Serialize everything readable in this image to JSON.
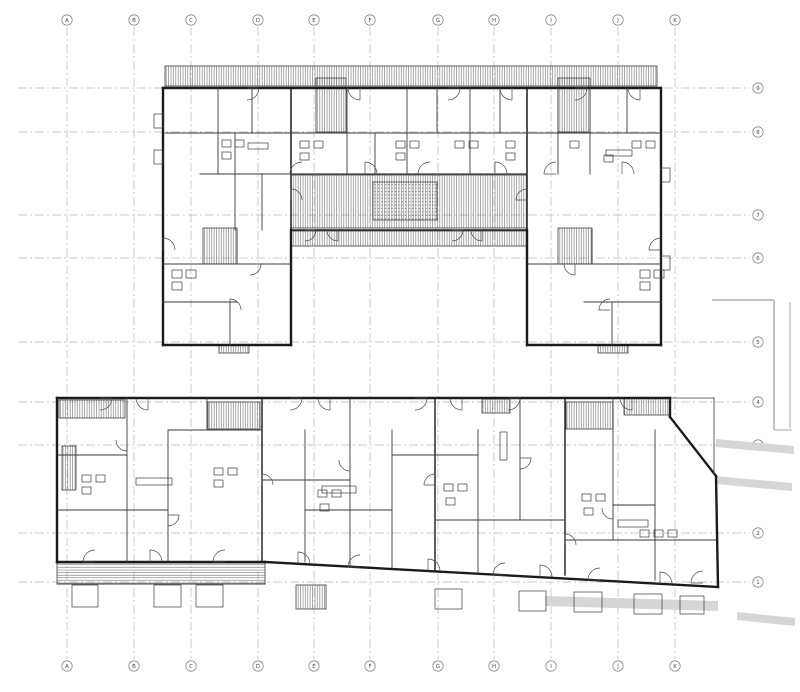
{
  "sheet": {
    "width": 800,
    "height": 692,
    "background": "#ffffff",
    "kind": "architectural floor plan, two buildings"
  },
  "colors": {
    "wall": "#1b1b1b",
    "thin_wall": "#3a3a3a",
    "hatch_line": "#707070",
    "grid_line": "#b8b8b8",
    "bubble_stroke": "#8a8a8a",
    "label_text": "#444444",
    "context_fill": "#d6d6d6",
    "context_stroke": "#c4c4c4"
  },
  "grid": {
    "bubble_r": 5.2,
    "col_bubble_top_y": 20,
    "col_bubble_bottom_y": 666,
    "col_line_y1": 27,
    "col_line_y2": 659,
    "row_bubble_x": 758,
    "row_line_x1": 18,
    "row_line_x2": 750,
    "columns": [
      {
        "label": "A",
        "x": 67
      },
      {
        "label": "B",
        "x": 134
      },
      {
        "label": "C",
        "x": 191
      },
      {
        "label": "D",
        "x": 258
      },
      {
        "label": "E",
        "x": 314
      },
      {
        "label": "F",
        "x": 370
      },
      {
        "label": "G",
        "x": 438
      },
      {
        "label": "H",
        "x": 494
      },
      {
        "label": "I",
        "x": 551
      },
      {
        "label": "J",
        "x": 618
      },
      {
        "label": "K",
        "x": 675
      }
    ],
    "rows": [
      {
        "label": "9",
        "y": 88
      },
      {
        "label": "8",
        "y": 132
      },
      {
        "label": "7",
        "y": 215
      },
      {
        "label": "6",
        "y": 258
      },
      {
        "label": "5",
        "y": 342
      },
      {
        "label": "4",
        "y": 402
      },
      {
        "label": "3",
        "y": 445
      },
      {
        "label": "2",
        "y": 533
      },
      {
        "label": "1",
        "y": 582
      }
    ]
  },
  "drawing": {
    "walls": [
      [
        163,
        88,
        661,
        88,
        2.4
      ],
      [
        163,
        88,
        163,
        345,
        2.4
      ],
      [
        661,
        88,
        661,
        345,
        2.4
      ],
      [
        163,
        345,
        291,
        345,
        2.4
      ],
      [
        527,
        345,
        661,
        345,
        2.4
      ],
      [
        291,
        230,
        291,
        345,
        2.4
      ],
      [
        527,
        230,
        527,
        345,
        2.4
      ],
      [
        291,
        88,
        291,
        230,
        1.5
      ],
      [
        527,
        88,
        527,
        230,
        1.5
      ],
      [
        165,
        133,
        659,
        133,
        0.9
      ],
      [
        291,
        174,
        527,
        174,
        1.2
      ],
      [
        291,
        230,
        527,
        230,
        1.5
      ],
      [
        218,
        88,
        218,
        174,
        0.9
      ],
      [
        252,
        88,
        252,
        133,
        0.9
      ],
      [
        347,
        88,
        347,
        174,
        0.9
      ],
      [
        375,
        133,
        375,
        174,
        0.9
      ],
      [
        407,
        88,
        407,
        174,
        0.9
      ],
      [
        437,
        88,
        437,
        133,
        0.9
      ],
      [
        470,
        88,
        470,
        174,
        0.9
      ],
      [
        500,
        88,
        500,
        133,
        0.9
      ],
      [
        558,
        88,
        558,
        174,
        0.9
      ],
      [
        590,
        88,
        590,
        174,
        0.9
      ],
      [
        627,
        88,
        627,
        133,
        0.9
      ],
      [
        235,
        133,
        235,
        230,
        0.9
      ],
      [
        262,
        174,
        262,
        230,
        0.9
      ],
      [
        200,
        174,
        291,
        174,
        0.9
      ],
      [
        163,
        264,
        291,
        264,
        0.9
      ],
      [
        163,
        302,
        237,
        302,
        0.9
      ],
      [
        237,
        230,
        237,
        264,
        0.9
      ],
      [
        230,
        302,
        230,
        345,
        0.9
      ],
      [
        527,
        264,
        661,
        264,
        0.9
      ],
      [
        584,
        302,
        661,
        302,
        0.9
      ],
      [
        612,
        302,
        612,
        345,
        0.9
      ],
      [
        592,
        230,
        592,
        264,
        0.9
      ],
      [
        57,
        398,
        670,
        398,
        2.4
      ],
      [
        57,
        398,
        57,
        562,
        2.4
      ],
      [
        57,
        562,
        265,
        562,
        2.4
      ],
      [
        265,
        562,
        718,
        587,
        2.4
      ],
      [
        716,
        476,
        718,
        587,
        2.4
      ],
      [
        670,
        417,
        716,
        476,
        2.4
      ],
      [
        670,
        398,
        670,
        417,
        2.4
      ],
      [
        670,
        398,
        714,
        398,
        0.8
      ],
      [
        714,
        398,
        714,
        474,
        0.8
      ],
      [
        127,
        398,
        127,
        562,
        0.9
      ],
      [
        168,
        430,
        168,
        562,
        0.9
      ],
      [
        207,
        398,
        207,
        430,
        0.9
      ],
      [
        262,
        398,
        262,
        562,
        1.4
      ],
      [
        305,
        430,
        305,
        562,
        0.9
      ],
      [
        350,
        398,
        350,
        566,
        0.9
      ],
      [
        392,
        430,
        392,
        568,
        0.9
      ],
      [
        435,
        398,
        435,
        570,
        1.4
      ],
      [
        478,
        430,
        478,
        572,
        0.9
      ],
      [
        520,
        398,
        520,
        520,
        0.9
      ],
      [
        565,
        398,
        565,
        575,
        1.4
      ],
      [
        613,
        398,
        613,
        540,
        0.9
      ],
      [
        655,
        430,
        655,
        580,
        0.9
      ],
      [
        168,
        430,
        262,
        430,
        0.9
      ],
      [
        57,
        455,
        127,
        455,
        0.9
      ],
      [
        57,
        510,
        168,
        510,
        0.9
      ],
      [
        262,
        480,
        350,
        480,
        0.9
      ],
      [
        305,
        510,
        392,
        510,
        0.9
      ],
      [
        392,
        455,
        478,
        455,
        0.9
      ],
      [
        435,
        520,
        565,
        520,
        0.9
      ],
      [
        565,
        540,
        716,
        540,
        0.9
      ],
      [
        613,
        505,
        655,
        505,
        0.9
      ],
      [
        57,
        584,
        265,
        584,
        0.9
      ]
    ],
    "hatch_rects": [
      [
        165,
        66,
        492,
        20,
        "v"
      ],
      [
        316,
        78,
        30,
        54,
        "v"
      ],
      [
        558,
        78,
        32,
        54,
        "v"
      ],
      [
        291,
        175,
        236,
        53,
        "v"
      ],
      [
        373,
        182,
        64,
        38,
        "dots"
      ],
      [
        291,
        231,
        236,
        15,
        "v"
      ],
      [
        203,
        228,
        34,
        36,
        "v"
      ],
      [
        558,
        228,
        34,
        36,
        "v"
      ],
      [
        219,
        345,
        30,
        8,
        "v"
      ],
      [
        598,
        345,
        30,
        8,
        "v"
      ],
      [
        59,
        400,
        66,
        18,
        "v"
      ],
      [
        624,
        398,
        46,
        17,
        "v"
      ],
      [
        482,
        399,
        28,
        14,
        "v"
      ],
      [
        208,
        402,
        52,
        27,
        "v"
      ],
      [
        566,
        402,
        47,
        27,
        "v"
      ],
      [
        57,
        563,
        208,
        21,
        "h"
      ],
      [
        296,
        585,
        30,
        24,
        "v"
      ],
      [
        62,
        446,
        14,
        44,
        "v"
      ]
    ],
    "fixtures": [
      [
        222,
        140,
        9,
        7
      ],
      [
        235,
        140,
        9,
        7
      ],
      [
        222,
        152,
        9,
        7
      ],
      [
        300,
        141,
        9,
        7
      ],
      [
        314,
        141,
        9,
        7
      ],
      [
        300,
        153,
        9,
        7
      ],
      [
        396,
        141,
        9,
        7
      ],
      [
        410,
        141,
        9,
        7
      ],
      [
        396,
        153,
        9,
        7
      ],
      [
        455,
        141,
        9,
        7
      ],
      [
        469,
        141,
        9,
        7
      ],
      [
        506,
        141,
        9,
        7
      ],
      [
        506,
        153,
        9,
        7
      ],
      [
        570,
        141,
        9,
        7
      ],
      [
        604,
        155,
        9,
        7
      ],
      [
        632,
        141,
        9,
        7
      ],
      [
        646,
        141,
        9,
        7
      ],
      [
        248,
        143,
        20,
        6
      ],
      [
        606,
        150,
        26,
        6
      ],
      [
        172,
        270,
        10,
        8
      ],
      [
        186,
        270,
        10,
        8
      ],
      [
        172,
        282,
        10,
        8
      ],
      [
        640,
        270,
        10,
        8
      ],
      [
        654,
        270,
        10,
        8
      ],
      [
        640,
        282,
        10,
        8
      ],
      [
        154,
        114,
        9,
        14
      ],
      [
        154,
        150,
        9,
        14
      ],
      [
        661,
        168,
        9,
        14
      ],
      [
        661,
        256,
        9,
        14
      ],
      [
        82,
        475,
        9,
        7
      ],
      [
        96,
        475,
        9,
        7
      ],
      [
        82,
        487,
        9,
        7
      ],
      [
        214,
        468,
        9,
        7
      ],
      [
        228,
        468,
        9,
        7
      ],
      [
        214,
        480,
        9,
        7
      ],
      [
        318,
        490,
        9,
        7
      ],
      [
        332,
        490,
        9,
        7
      ],
      [
        320,
        504,
        9,
        7
      ],
      [
        444,
        484,
        9,
        7
      ],
      [
        458,
        484,
        9,
        7
      ],
      [
        446,
        498,
        9,
        7
      ],
      [
        582,
        494,
        9,
        7
      ],
      [
        596,
        494,
        9,
        7
      ],
      [
        584,
        508,
        9,
        7
      ],
      [
        640,
        530,
        9,
        7
      ],
      [
        654,
        530,
        9,
        7
      ],
      [
        668,
        530,
        9,
        7
      ],
      [
        136,
        478,
        36,
        7
      ],
      [
        322,
        486,
        34,
        7
      ],
      [
        500,
        432,
        7,
        28
      ],
      [
        618,
        520,
        30,
        7
      ],
      [
        72,
        585,
        26,
        22
      ],
      [
        154,
        585,
        27,
        22
      ],
      [
        196,
        585,
        27,
        22
      ],
      [
        435,
        589,
        27,
        20
      ],
      [
        519,
        591,
        27,
        20
      ],
      [
        574,
        592,
        28,
        20
      ],
      [
        634,
        594,
        28,
        20
      ],
      [
        680,
        596,
        24,
        18
      ]
    ],
    "doors": [
      [
        247,
        88,
        12,
        0
      ],
      [
        360,
        88,
        12,
        90
      ],
      [
        448,
        88,
        12,
        0
      ],
      [
        512,
        88,
        12,
        90
      ],
      [
        575,
        88,
        12,
        0
      ],
      [
        640,
        88,
        12,
        90
      ],
      [
        302,
        174,
        12,
        180
      ],
      [
        365,
        174,
        12,
        270
      ],
      [
        430,
        174,
        12,
        180
      ],
      [
        495,
        174,
        12,
        270
      ],
      [
        556,
        174,
        12,
        180
      ],
      [
        622,
        174,
        12,
        270
      ],
      [
        305,
        230,
        11,
        0
      ],
      [
        338,
        230,
        11,
        90
      ],
      [
        452,
        230,
        11,
        0
      ],
      [
        482,
        230,
        11,
        90
      ],
      [
        163,
        250,
        12,
        270
      ],
      [
        250,
        264,
        11,
        0
      ],
      [
        230,
        310,
        11,
        270
      ],
      [
        610,
        310,
        11,
        180
      ],
      [
        575,
        264,
        11,
        90
      ],
      [
        661,
        250,
        12,
        180
      ],
      [
        291,
        200,
        11,
        270
      ],
      [
        527,
        200,
        11,
        180
      ],
      [
        100,
        398,
        12,
        0
      ],
      [
        148,
        398,
        12,
        90
      ],
      [
        290,
        398,
        12,
        0
      ],
      [
        330,
        398,
        12,
        90
      ],
      [
        415,
        398,
        12,
        0
      ],
      [
        462,
        398,
        12,
        90
      ],
      [
        508,
        398,
        12,
        0
      ],
      [
        632,
        398,
        12,
        90
      ],
      [
        95,
        562,
        12,
        180
      ],
      [
        150,
        562,
        12,
        270
      ],
      [
        225,
        562,
        12,
        180
      ],
      [
        298,
        564,
        12,
        270
      ],
      [
        360,
        567,
        12,
        180
      ],
      [
        428,
        571,
        12,
        270
      ],
      [
        505,
        575,
        12,
        180
      ],
      [
        540,
        577,
        12,
        270
      ],
      [
        600,
        580,
        12,
        180
      ],
      [
        660,
        584,
        12,
        270
      ],
      [
        703,
        583,
        12,
        180
      ],
      [
        127,
        440,
        11,
        90
      ],
      [
        168,
        515,
        11,
        0
      ],
      [
        262,
        485,
        11,
        270
      ],
      [
        350,
        460,
        11,
        90
      ],
      [
        435,
        485,
        11,
        180
      ],
      [
        520,
        458,
        11,
        0
      ],
      [
        565,
        545,
        11,
        270
      ],
      [
        613,
        508,
        11,
        90
      ]
    ],
    "context_lines": [
      [
        712,
        300,
        774,
        300,
        2
      ],
      [
        774,
        300,
        774,
        430,
        2
      ],
      [
        790,
        302,
        790,
        428,
        1.5
      ],
      [
        774,
        430,
        792,
        430,
        1.5
      ]
    ],
    "context_polys": [
      "716,439 794,446 794,454 716,447",
      "716,476 792,483 792,491 716,484",
      "545,596 718,601 718,611 545,606",
      "737,612 795,618 795,626 737,620"
    ]
  }
}
